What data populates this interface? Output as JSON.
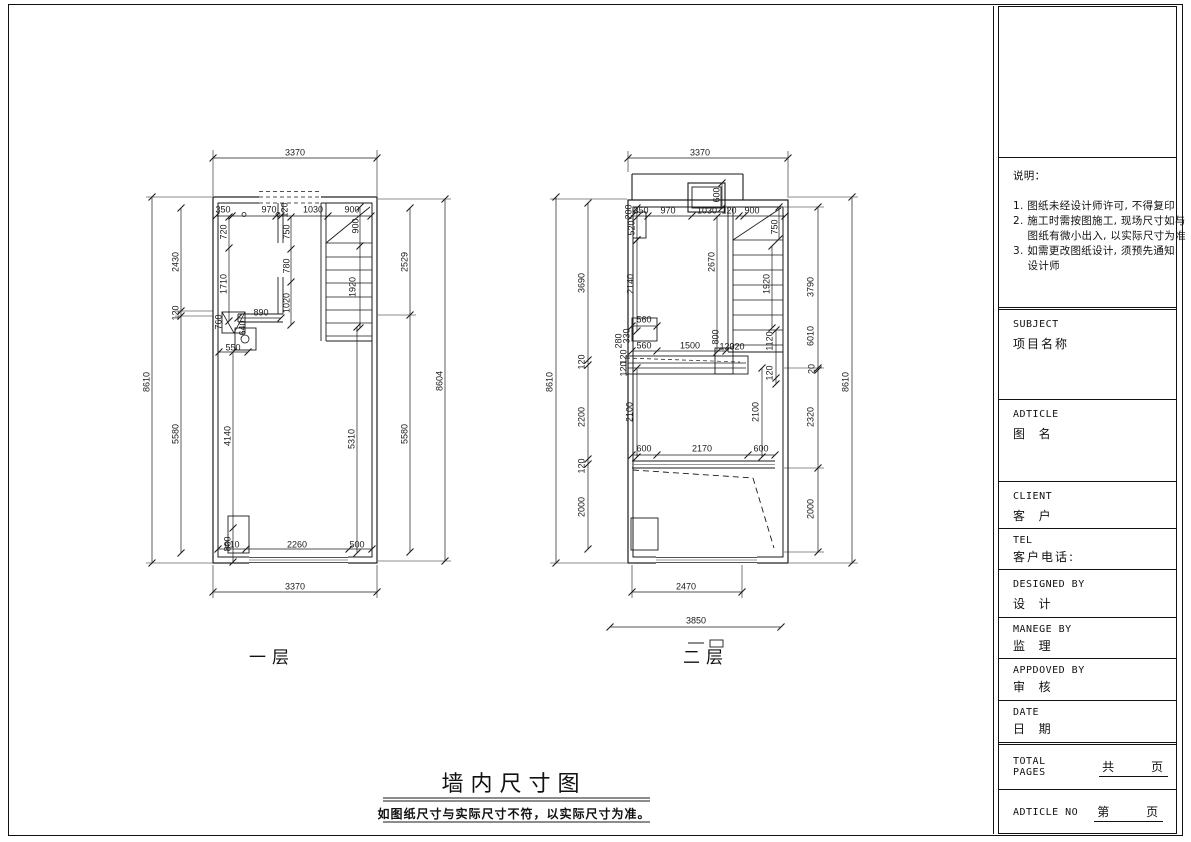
{
  "footer": {
    "title": "墙内尺寸图",
    "note": "如图纸尺寸与实际尺寸不符，以实际尺寸为准。"
  },
  "plans": {
    "floor1": {
      "label": "一层"
    },
    "floor2": {
      "label": "二层"
    }
  },
  "title_block": {
    "notes": {
      "lines": [
        "说明：",
        "",
        "1. 图纸未经设计师许可, 不得复印.",
        "2. 施工时需按图施工, 现场尺寸如与",
        "    图纸有微小出入, 以实际尺寸为准",
        "3. 如需更改图纸设计, 须预先通知",
        "    设计师"
      ]
    },
    "rows": [
      {
        "en": "SUBJECT",
        "cn": "项目名称"
      },
      {
        "en": "ADTICLE",
        "cn": "图  名"
      },
      {
        "en": "CLIENT",
        "cn": "客  户"
      },
      {
        "en": "TEL",
        "cn": "客户电话:"
      },
      {
        "en": "DESIGNED BY",
        "cn": "设  计"
      },
      {
        "en": "MANEGE BY",
        "cn": "监  理"
      },
      {
        "en": "APPDOVED BY",
        "cn": "审  核"
      },
      {
        "en": "DATE",
        "cn": "日  期"
      },
      {
        "en": "TOTAL PAGES",
        "cn": "共      页",
        "underline": true
      },
      {
        "en": "ADTICLE NO",
        "cn": "第      页",
        "underline": true
      }
    ]
  },
  "dim_labels": [
    {
      "t": "3370",
      "x": 295,
      "y": 153
    },
    {
      "t": "350",
      "x": 223,
      "y": 210
    },
    {
      "t": "970",
      "x": 269,
      "y": 210
    },
    {
      "t": "120",
      "x": 285,
      "y": 210,
      "v": 1
    },
    {
      "t": "1030",
      "x": 313,
      "y": 210
    },
    {
      "t": "900",
      "x": 352,
      "y": 210
    },
    {
      "t": "720",
      "x": 224,
      "y": 232,
      "v": 1
    },
    {
      "t": "1710",
      "x": 224,
      "y": 284,
      "v": 1
    },
    {
      "t": "750",
      "x": 287,
      "y": 232,
      "v": 1
    },
    {
      "t": "780",
      "x": 287,
      "y": 266,
      "v": 1
    },
    {
      "t": "1020",
      "x": 287,
      "y": 303,
      "v": 1
    },
    {
      "t": "900",
      "x": 356,
      "y": 226,
      "v": 1
    },
    {
      "t": "1920",
      "x": 353,
      "y": 287,
      "v": 1
    },
    {
      "t": "890",
      "x": 261,
      "y": 313
    },
    {
      "t": "760",
      "x": 219,
      "y": 322,
      "v": 1
    },
    {
      "t": "640",
      "x": 243,
      "y": 328,
      "v": 1
    },
    {
      "t": "550",
      "x": 233,
      "y": 348
    },
    {
      "t": "2430",
      "x": 176,
      "y": 262,
      "v": 1
    },
    {
      "t": "120",
      "x": 176,
      "y": 313,
      "v": 1
    },
    {
      "t": "5580",
      "x": 176,
      "y": 434,
      "v": 1
    },
    {
      "t": "8610",
      "x": 147,
      "y": 382,
      "v": 1
    },
    {
      "t": "2529",
      "x": 405,
      "y": 262,
      "v": 1
    },
    {
      "t": "5580",
      "x": 405,
      "y": 434,
      "v": 1
    },
    {
      "t": "8604",
      "x": 440,
      "y": 381,
      "v": 1
    },
    {
      "t": "4140",
      "x": 228,
      "y": 436,
      "v": 1
    },
    {
      "t": "5310",
      "x": 352,
      "y": 439,
      "v": 1
    },
    {
      "t": "800",
      "x": 228,
      "y": 544,
      "v": 1
    },
    {
      "t": "610",
      "x": 232,
      "y": 545
    },
    {
      "t": "2260",
      "x": 297,
      "y": 545
    },
    {
      "t": "500",
      "x": 357,
      "y": 545
    },
    {
      "t": "3370",
      "x": 295,
      "y": 587
    },
    {
      "t": "3370",
      "x": 700,
      "y": 153
    },
    {
      "t": "600",
      "x": 717,
      "y": 195,
      "v": 1
    },
    {
      "t": "350",
      "x": 641,
      "y": 211
    },
    {
      "t": "970",
      "x": 668,
      "y": 211
    },
    {
      "t": "1030",
      "x": 707,
      "y": 211
    },
    {
      "t": "120",
      "x": 729,
      "y": 211
    },
    {
      "t": "900",
      "x": 752,
      "y": 211
    },
    {
      "t": "200",
      "x": 629,
      "y": 212,
      "v": 1
    },
    {
      "t": "520",
      "x": 632,
      "y": 228,
      "v": 1
    },
    {
      "t": "750",
      "x": 775,
      "y": 227,
      "v": 1
    },
    {
      "t": "2670",
      "x": 712,
      "y": 262,
      "v": 1
    },
    {
      "t": "1920",
      "x": 767,
      "y": 284,
      "v": 1
    },
    {
      "t": "2140",
      "x": 631,
      "y": 284,
      "v": 1
    },
    {
      "t": "560",
      "x": 644,
      "y": 320
    },
    {
      "t": "330",
      "x": 627,
      "y": 336,
      "v": 1
    },
    {
      "t": "560",
      "x": 644,
      "y": 346
    },
    {
      "t": "280",
      "x": 619,
      "y": 341,
      "v": 1
    },
    {
      "t": "1500",
      "x": 690,
      "y": 346
    },
    {
      "t": "800",
      "x": 716,
      "y": 337,
      "v": 1
    },
    {
      "t": "120",
      "x": 727,
      "y": 347
    },
    {
      "t": "320",
      "x": 737,
      "y": 347
    },
    {
      "t": "120",
      "x": 624,
      "y": 357,
      "v": 1
    },
    {
      "t": "120",
      "x": 624,
      "y": 369,
      "v": 1
    },
    {
      "t": "1120",
      "x": 770,
      "y": 341,
      "v": 1
    },
    {
      "t": "120",
      "x": 770,
      "y": 373,
      "v": 1
    },
    {
      "t": "3690",
      "x": 582,
      "y": 283,
      "v": 1
    },
    {
      "t": "120",
      "x": 582,
      "y": 362,
      "v": 1
    },
    {
      "t": "2200",
      "x": 582,
      "y": 417,
      "v": 1
    },
    {
      "t": "120",
      "x": 582,
      "y": 466,
      "v": 1
    },
    {
      "t": "2000",
      "x": 582,
      "y": 507,
      "v": 1
    },
    {
      "t": "8610",
      "x": 550,
      "y": 382,
      "v": 1
    },
    {
      "t": "2100",
      "x": 630,
      "y": 412,
      "v": 1
    },
    {
      "t": "2100",
      "x": 756,
      "y": 412,
      "v": 1
    },
    {
      "t": "600",
      "x": 644,
      "y": 449
    },
    {
      "t": "2170",
      "x": 702,
      "y": 449
    },
    {
      "t": "600",
      "x": 761,
      "y": 449
    },
    {
      "t": "3790",
      "x": 811,
      "y": 287,
      "v": 1
    },
    {
      "t": "6010",
      "x": 811,
      "y": 336,
      "v": 1
    },
    {
      "t": "20",
      "x": 812,
      "y": 369,
      "v": 1
    },
    {
      "t": "2320",
      "x": 811,
      "y": 417,
      "v": 1
    },
    {
      "t": "2000",
      "x": 811,
      "y": 509,
      "v": 1
    },
    {
      "t": "8610",
      "x": 846,
      "y": 382,
      "v": 1
    },
    {
      "t": "2470",
      "x": 686,
      "y": 587
    },
    {
      "t": "3850",
      "x": 696,
      "y": 621
    }
  ]
}
